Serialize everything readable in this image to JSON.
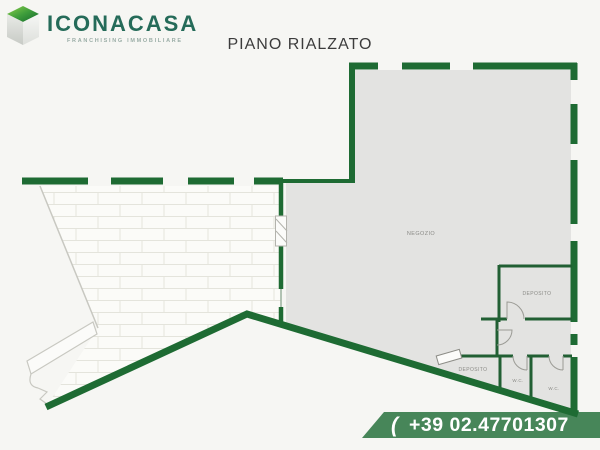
{
  "logo": {
    "brand": "ICONACASA",
    "tagline": "FRANCHISING IMMOBILIARE"
  },
  "title": "PIANO RIALZATO",
  "plan": {
    "floor_name": "PIANO RIALZATO",
    "rooms": [
      {
        "label": "NEGOZIO"
      },
      {
        "label": "DEPOSITO"
      },
      {
        "label": "DEPOSITO"
      },
      {
        "label": "W.C."
      },
      {
        "label": "W.C."
      }
    ]
  },
  "contact": {
    "phone_icon": "(",
    "phone": "+39 02.47701307"
  },
  "colors": {
    "wall_green": "#1e6b33",
    "interior_wall_green": "#215f33",
    "banner_green": "#478659",
    "room_fill": "#e3e3e1",
    "paving_line": "#e4e4dc",
    "brand_text": "#256b59",
    "logo_green_light": "#7cc63f",
    "logo_green_dark": "#1d7c33",
    "phone_text": "#ffffff",
    "title_text": "#3c3c3c"
  }
}
